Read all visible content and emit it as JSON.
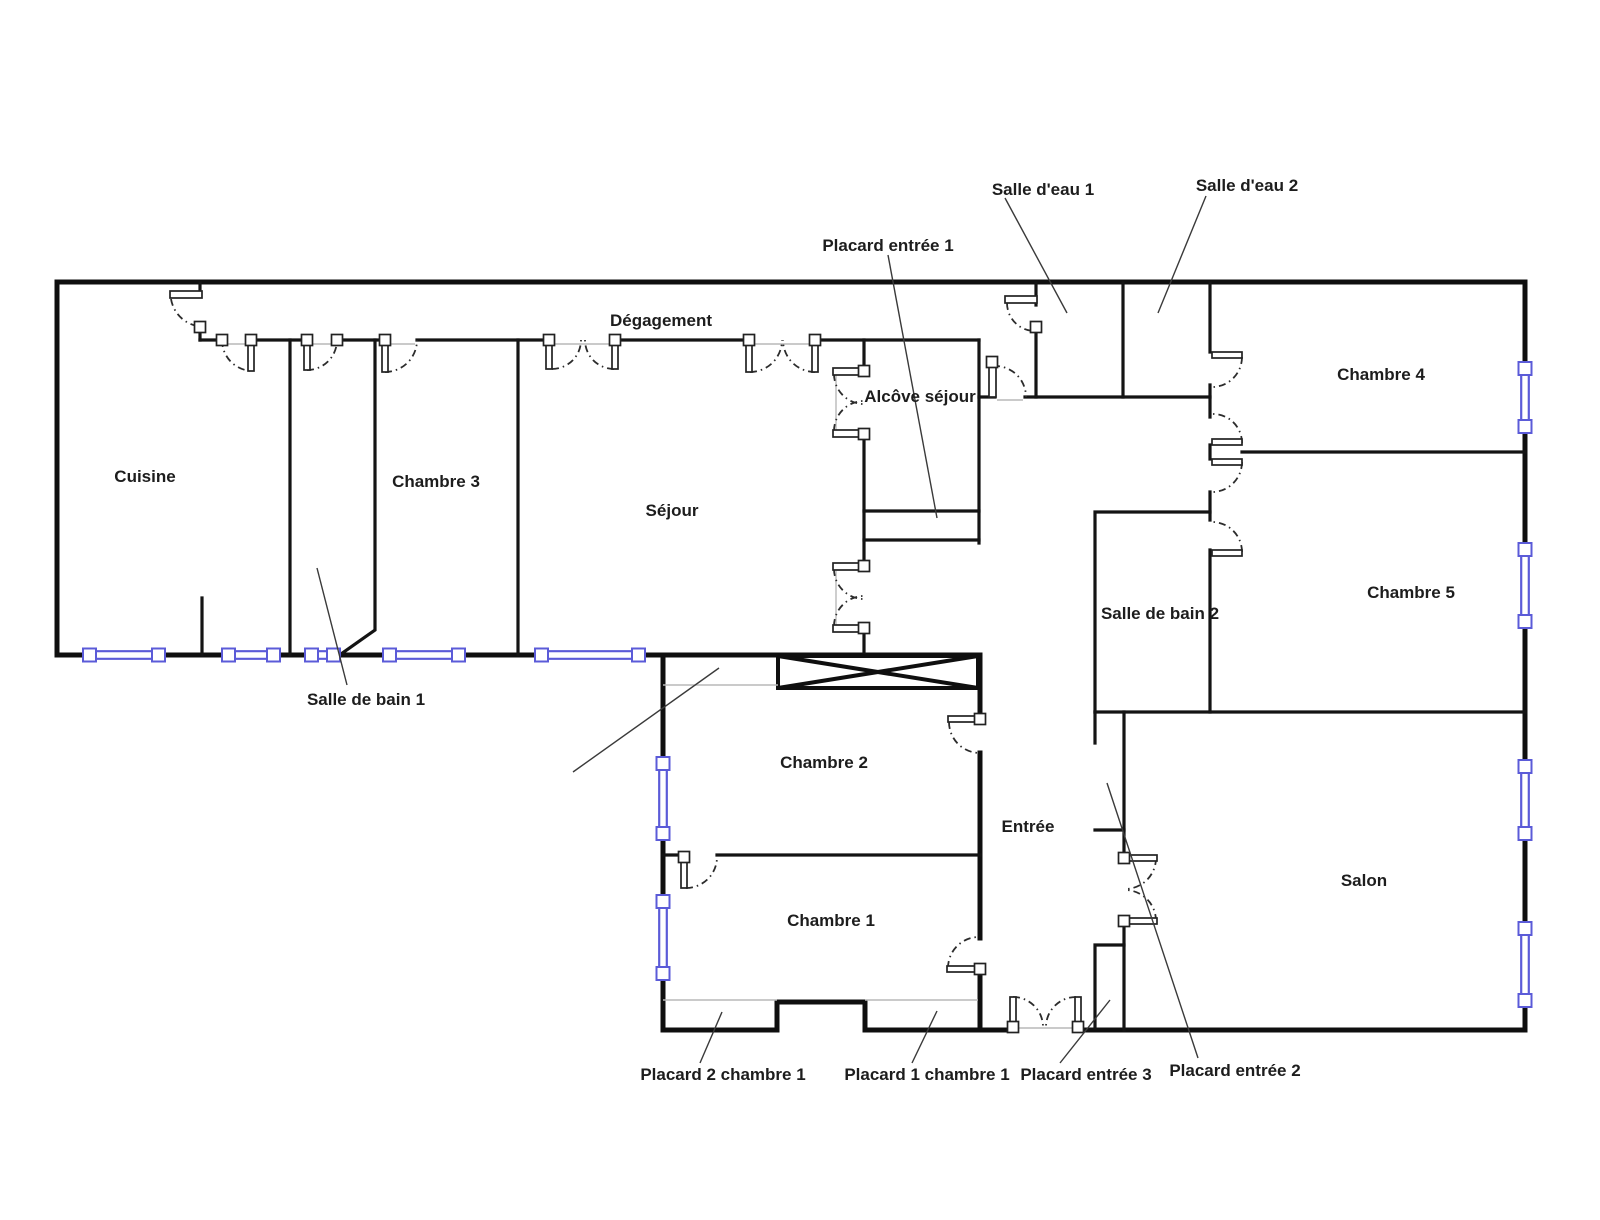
{
  "colors": {
    "background": "#ffffff",
    "wall": "#0f0f0f",
    "window_accent": "#5b5bd8",
    "label_text": "#1d1d1d",
    "leader_line": "#3a3a3a",
    "opening_line": "#b9b9b9"
  },
  "rooms": {
    "cuisine": {
      "label": "Cuisine"
    },
    "chambre_3": {
      "label": "Chambre 3"
    },
    "sejour": {
      "label": "Séjour"
    },
    "degagement": {
      "label": "Dégagement"
    },
    "alcove_sejour": {
      "label": "Alcôve séjour"
    },
    "salle_d_eau_1": {
      "label": "Salle d'eau 1"
    },
    "salle_d_eau_2": {
      "label": "Salle d'eau 2"
    },
    "chambre_4": {
      "label": "Chambre 4"
    },
    "chambre_5": {
      "label": "Chambre 5"
    },
    "salle_de_bain_2": {
      "label": "Salle de bain 2"
    },
    "chambre_2": {
      "label": "Chambre 2"
    },
    "chambre_1": {
      "label": "Chambre 1"
    },
    "entree": {
      "label": "Entrée"
    },
    "salon": {
      "label": "Salon"
    }
  },
  "callouts": {
    "placard_entree_1": {
      "label": "Placard entrée 1"
    },
    "salle_de_bain_1": {
      "label": "Salle de bain 1"
    },
    "placard_2_chambre_1": {
      "label": "Placard 2 chambre 1"
    },
    "placard_1_chambre_1": {
      "label": "Placard 1 chambre 1"
    },
    "placard_entree_3": {
      "label": "Placard entrée 3"
    },
    "placard_entree_2": {
      "label": "Placard entrée 2"
    }
  }
}
